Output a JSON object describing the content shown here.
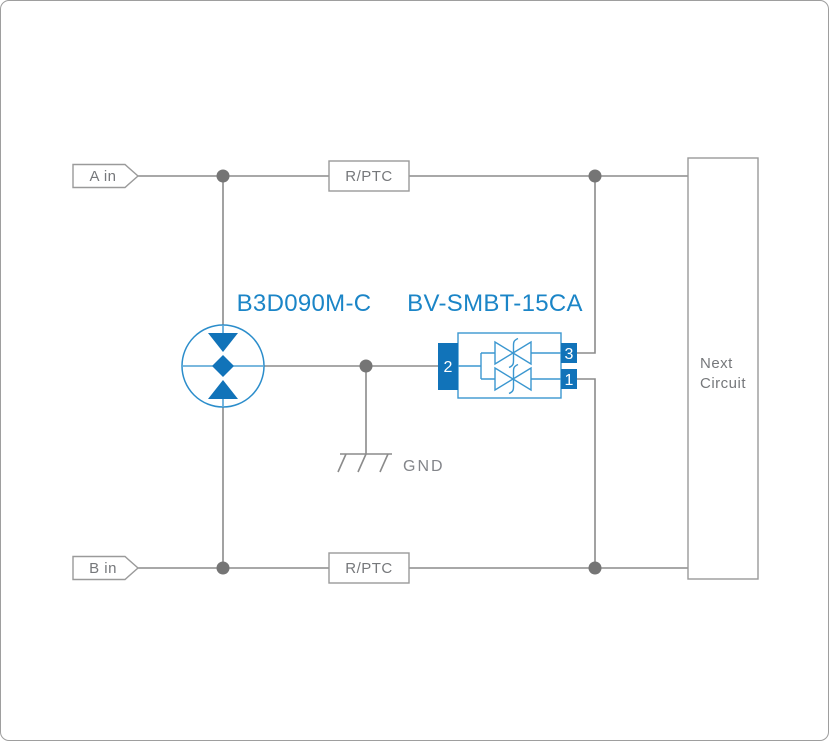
{
  "labels": {
    "input_a": "A in",
    "input_b": "B in",
    "rptc_top": "R/PTC",
    "rptc_bottom": "R/PTC",
    "gdt_part": "B3D090M-C",
    "tvs_part": "BV-SMBT-15CA",
    "gnd": "GND",
    "next_line1": "Next",
    "next_line2": "Circuit"
  },
  "tvs": {
    "pin_left": "2",
    "pin_top_right": "3",
    "pin_bottom_right": "1"
  },
  "colors": {
    "accent_blue": "#1173b9",
    "symbol_stroke_blue": "#3b97d0",
    "part_label_blue": "#1b85c7",
    "wire_gray": "#8b8b8b",
    "box_border_gray": "#9a9a9a",
    "text_gray": "#76787b",
    "junction_dot_gray": "#757575"
  }
}
